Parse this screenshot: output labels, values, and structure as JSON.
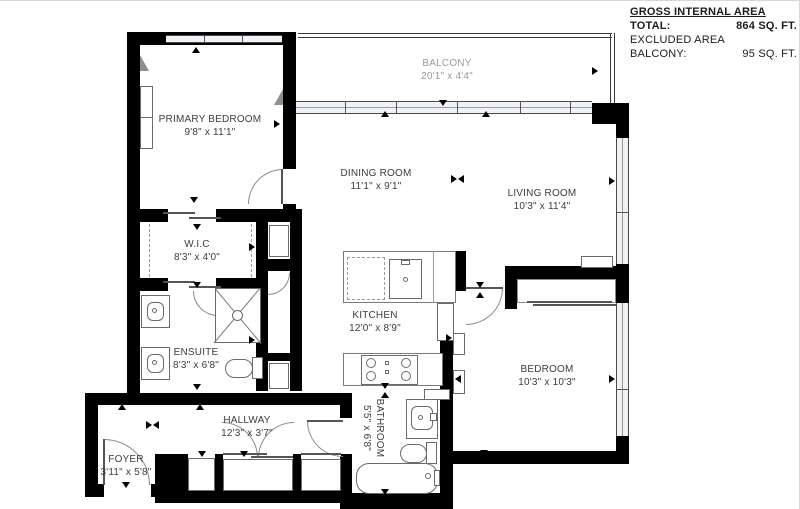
{
  "legend": {
    "title": "GROSS INTERNAL AREA",
    "total_label": "TOTAL:",
    "total_value": "864 SQ. FT.",
    "excluded_label": "EXCLUDED AREA",
    "balcony_label": "BALCONY:",
    "balcony_value": "95 SQ. FT."
  },
  "rooms": {
    "balcony": {
      "name": "BALCONY",
      "dims": "20'1\" x 4'4\""
    },
    "primary_bedroom": {
      "name": "PRIMARY BEDROOM",
      "dims": "9'8\" x 11'1\""
    },
    "dining_room": {
      "name": "DINING ROOM",
      "dims": "11'1\" x 9'1\""
    },
    "living_room": {
      "name": "LIVING ROOM",
      "dims": "10'3\" x 11'4\""
    },
    "wic": {
      "name": "W.I.C",
      "dims": "8'3\" x 4'0\""
    },
    "kitchen": {
      "name": "KITCHEN",
      "dims": "12'0\" x 8'9\""
    },
    "ensuite": {
      "name": "ENSUITE",
      "dims": "8'3\" x 6'8\""
    },
    "bedroom": {
      "name": "BEDROOM",
      "dims": "10'3\" x 10'3\""
    },
    "hallway": {
      "name": "HALLWAY",
      "dims": "12'3\" x 3'7\""
    },
    "bathroom": {
      "name": "BATHROOM",
      "dims": "5'5\" x 6'8\""
    },
    "foyer": {
      "name": "FOYER",
      "dims": "3'11\" x 5'8\""
    }
  },
  "colors": {
    "wall": "#000000",
    "room_label": "#3c3c3c",
    "balcony_label": "#9a9a9a",
    "fixture_line": "#6a6a6a"
  }
}
